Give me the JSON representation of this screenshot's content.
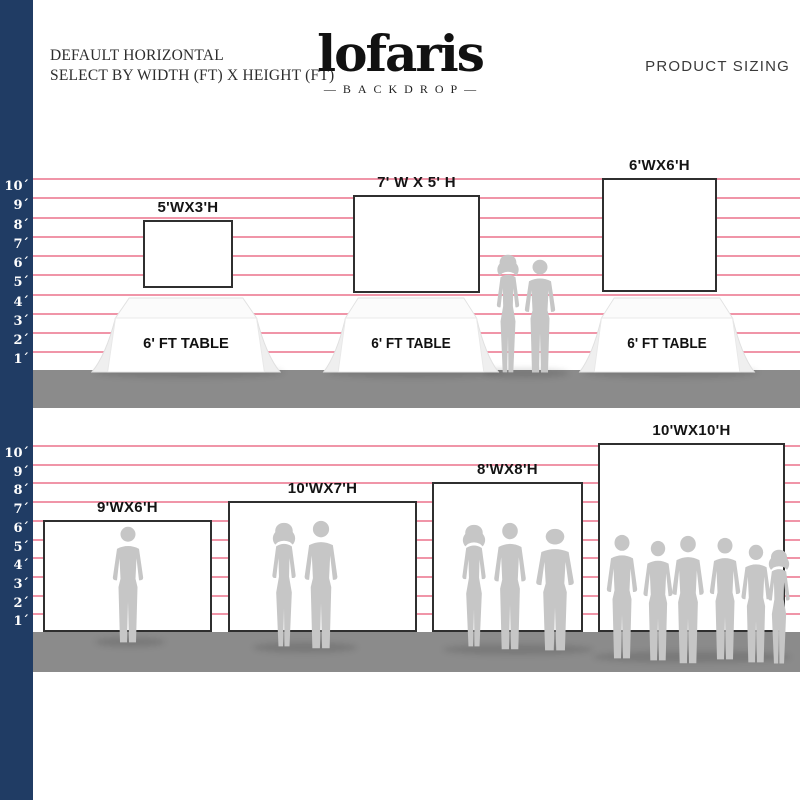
{
  "header": {
    "left_line1": "DEFAULT HORIZONTAL",
    "left_line2": "SELECT BY WIDTH (FT) X HEIGHT (FT)",
    "logo_text": "lofaris",
    "logo_sub": "—BACKDROP—",
    "right_title": "PRODUCT SIZING"
  },
  "ruler_labels": [
    "10´",
    "9´",
    "8´",
    "7´",
    "6´",
    "5´",
    "4´",
    "3´",
    "2´",
    "1´"
  ],
  "top_section": {
    "table_label": "6' FT TABLE",
    "tables": 3,
    "people_silhouettes": 2,
    "backdrops": [
      {
        "label": "5'WX3'H",
        "width_ft": 5,
        "height_ft": 3
      },
      {
        "label": "7' W X 5' H",
        "width_ft": 7,
        "height_ft": 5
      },
      {
        "label": "6'WX6'H",
        "width_ft": 6,
        "height_ft": 6
      }
    ]
  },
  "bottom_section": {
    "backdrops": [
      {
        "label": "9'WX6'H",
        "width_ft": 9,
        "height_ft": 6,
        "people_silhouettes": 1
      },
      {
        "label": "10'WX7'H",
        "width_ft": 10,
        "height_ft": 7,
        "people_silhouettes": 2
      },
      {
        "label": "8'WX8'H",
        "width_ft": 8,
        "height_ft": 8,
        "people_silhouettes": 3
      },
      {
        "label": "10'WX10'H",
        "width_ft": 10,
        "height_ft": 10,
        "people_silhouettes": 6
      }
    ]
  },
  "colors": {
    "ruler_bar": "#203c64",
    "guide_line": "#f095a8",
    "floor": "#8b8b8b",
    "silhouette": "#c6c6c6",
    "backdrop_border": "#2f2f2f"
  }
}
